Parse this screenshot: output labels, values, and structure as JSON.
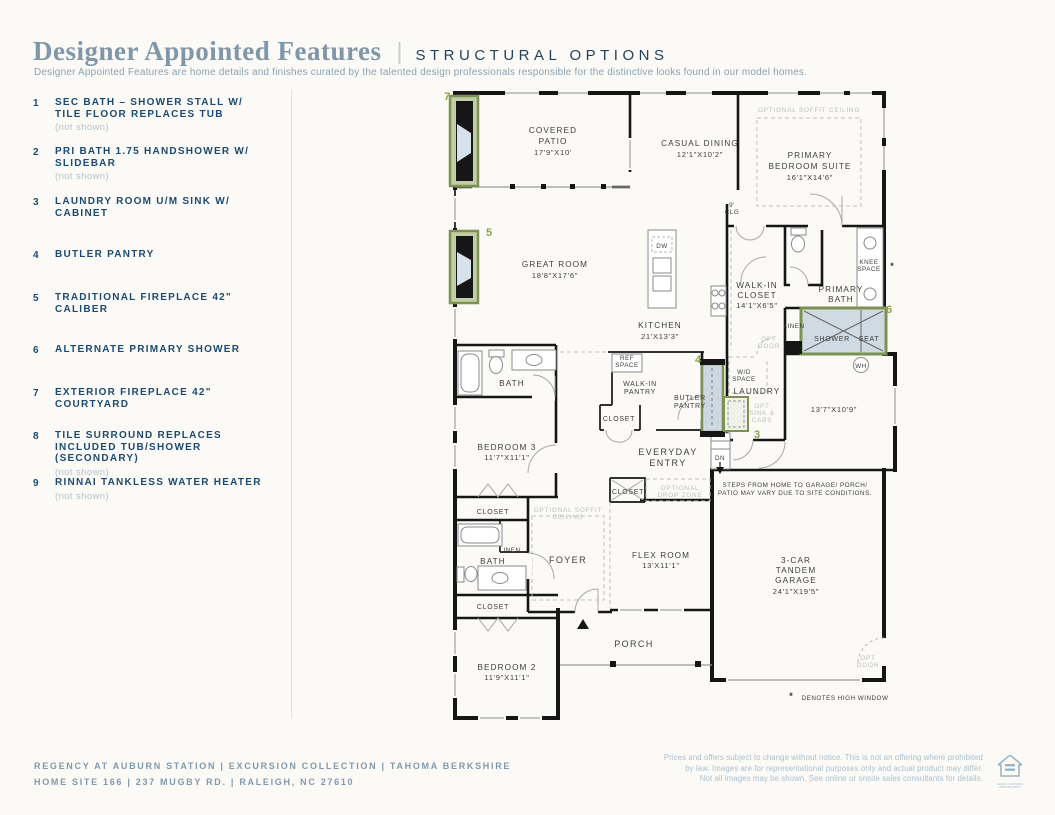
{
  "header": {
    "title": "Designer Appointed Features",
    "divider": "|",
    "tagline": "STRUCTURAL OPTIONS",
    "description": "Designer Appointed Features are home details and finishes curated by the talented design professionals responsible for the distinctive looks found in our model homes."
  },
  "options": [
    {
      "num": "1",
      "label": "SEC BATH – SHOWER STALL W/ TILE FLOOR REPLACES TUB",
      "note": "(not shown)"
    },
    {
      "num": "2",
      "label": "PRI BATH 1.75 HANDSHOWER W/ SLIDEBAR",
      "note": "(not shown)"
    },
    {
      "num": "3",
      "label": "LAUNDRY ROOM U/M SINK W/ CABINET",
      "note": ""
    },
    {
      "num": "4",
      "label": "BUTLER PANTRY",
      "note": ""
    },
    {
      "num": "5",
      "label": "TRADITIONAL FIREPLACE 42\" CALIBER",
      "note": ""
    },
    {
      "num": "6",
      "label": "ALTERNATE PRIMARY SHOWER",
      "note": ""
    },
    {
      "num": "7",
      "label": "EXTERIOR FIREPLACE 42\" COURTYARD",
      "note": ""
    },
    {
      "num": "8",
      "label": "TILE SURROUND REPLACES INCLUDED TUB/SHOWER (SECONDARY)",
      "note": "(not shown)"
    },
    {
      "num": "9",
      "label": "RINNAI TANKLESS WATER HEATER",
      "note": "(not shown)"
    }
  ],
  "plan": {
    "markers": {
      "m7": "7",
      "m5": "5",
      "m6": "6",
      "m4": "4",
      "m3": "3"
    },
    "covered_patio": [
      "COVERED",
      "PATIO",
      "17'9\"X10'"
    ],
    "casual_dining": [
      "CASUAL DINING",
      "12'1\"X10'2\""
    ],
    "primary_suite": [
      "PRIMARY",
      "BEDROOM SUITE",
      "16'1\"X14'6\""
    ],
    "soffit_suite": "OPTIONAL SOFFIT CEILING",
    "great_room": [
      "GREAT ROOM",
      "18'8\"X17'6\""
    ],
    "kitchen": [
      "KITCHEN",
      "21'X13'3\""
    ],
    "dw": "DW",
    "walk_in_closet": [
      "WALK-IN",
      "CLOSET",
      "14'1\"X6'5\""
    ],
    "primary_bath": [
      "PRIMARY",
      "BATH"
    ],
    "knee_space": [
      "KNEE",
      "SPACE"
    ],
    "high_window_asterisk": "*",
    "linen_primary": "LINEN",
    "opt_door_wic": [
      "OPT",
      "DOOR"
    ],
    "shower": [
      "SHOWER",
      "SEAT"
    ],
    "wh": "WH",
    "clg9": [
      "9'",
      "CLG"
    ],
    "ref_space": [
      "REF",
      "SPACE"
    ],
    "walk_in_pantry": [
      "WALK-IN",
      "PANTRY"
    ],
    "butler_pantry": [
      "BUTLER",
      "PANTRY"
    ],
    "wd_space": [
      "W/D",
      "SPACE"
    ],
    "laundry": "LAUNDRY",
    "opt_sink": [
      "OPT",
      "SINK &",
      "CABS"
    ],
    "closet_pantry": "CLOSET",
    "everyday_entry": [
      "EVERYDAY",
      "ENTRY"
    ],
    "dn": "DN",
    "courtyard_dim": "13'7\"X10'9\"",
    "steps_note": [
      "STEPS FROM HOME TO GARAGE/ PORCH/",
      "PATIO MAY VARY DUE TO SITE CONDITIONS."
    ],
    "bath3": "BATH",
    "bedroom3": [
      "BEDROOM 3",
      "11'7\"X11'1\""
    ],
    "closet_b3": "CLOSET",
    "closet_ee": "CLOSET",
    "drop_zone": [
      "OPTIONAL",
      "DROP ZONE"
    ],
    "soffit_foyer": [
      "OPTIONAL SOFFIT",
      "CEILING"
    ],
    "linen_bath2": "LINEN",
    "bath2": "BATH",
    "foyer": "FOYER",
    "flex": [
      "FLEX ROOM",
      "13'X11'1\""
    ],
    "closet_b2": "CLOSET",
    "porch": "PORCH",
    "bedroom2": [
      "BEDROOM 2",
      "11'9\"X11'1\""
    ],
    "garage": [
      "3-CAR",
      "TANDEM",
      "GARAGE",
      "24'1\"X19'5\""
    ],
    "opt_door_garage": [
      "OPT",
      "DOOR"
    ],
    "high_window_note": [
      "*",
      "DENOTES HIGH WINDOW"
    ]
  },
  "footer": {
    "left_line1": "REGENCY AT AUBURN STATION  |  EXCURSION COLLECTION  |  TAHOMA BERKSHIRE",
    "left_line2": "HOME SITE 166   |   237 MUGBY RD.  |   RALEIGH, NC 27610",
    "disclaimer": [
      "Prices and offers subject to change without notice. This is not an offering where prohibited",
      "by law. Images are for representational purposes only and actual product may differ.",
      "Not all images may be shown. See online or onsite sales consultants for details."
    ],
    "equal_housing_label": "EQUAL HOUSING OPPORTUNITY"
  },
  "colors": {
    "accent_green_border": "#7d9150",
    "marker_green": "#8ca445",
    "navy": "#1d4a70",
    "title_blue": "#8096a9",
    "background": "#fbfaf7"
  }
}
